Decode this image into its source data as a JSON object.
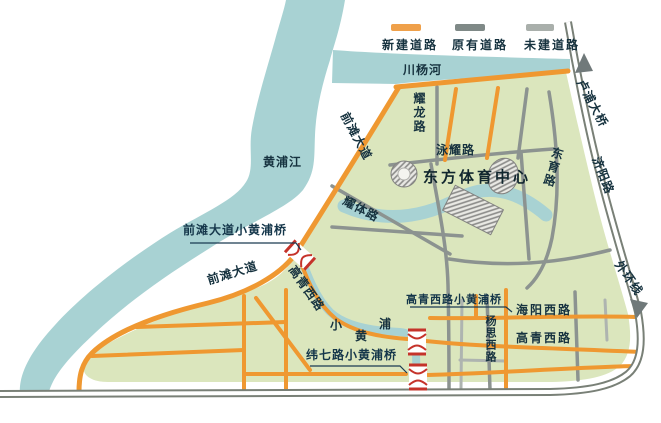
{
  "colors": {
    "land": "#dbe6bd",
    "water": "#a8d2d3",
    "road_new": "#ef9831",
    "road_existing": "#8c9390",
    "road_unbuilt": "#aeb4b0",
    "expressway": "#798077",
    "bridge_icon_red": "#c5332a",
    "label_text": "#16323f"
  },
  "legend": {
    "new_road": "新建道路",
    "existing_road": "原有道路",
    "unbuilt_road": "未建道路"
  },
  "waters": {
    "huangpu_river": "黄浦江",
    "chuanyang_river": "川杨河",
    "xiaohuangpu": {
      "char1": "小",
      "char2": "黄",
      "char3": "浦"
    }
  },
  "poi": {
    "sports_center": "东方体育中心"
  },
  "roads": {
    "qiantan_ave_upper": "前滩大道",
    "qiantan_ave_lower": "前滩大道",
    "yaolong_rd": "耀龙路",
    "yongyao_rd": "泳耀路",
    "dongyu_rd": "东育路",
    "yaoti_rd": "耀体路",
    "lupu_bridge": "卢浦大桥",
    "jiyang_rd": "济阳路",
    "outer_ring": "外环线",
    "gaoqing_west_rd_river": "高青西路",
    "gaoqing_west_rd_east": "高青西路",
    "haiyang_west_rd": "海阳西路",
    "yangsi_west_rd": "杨思西路"
  },
  "bridges": {
    "qiantan_bridge": "前滩大道小黄浦桥",
    "gaoqing_bridge": "高青西路小黄浦桥",
    "weiqi_bridge": "纬七路小黄浦桥"
  }
}
